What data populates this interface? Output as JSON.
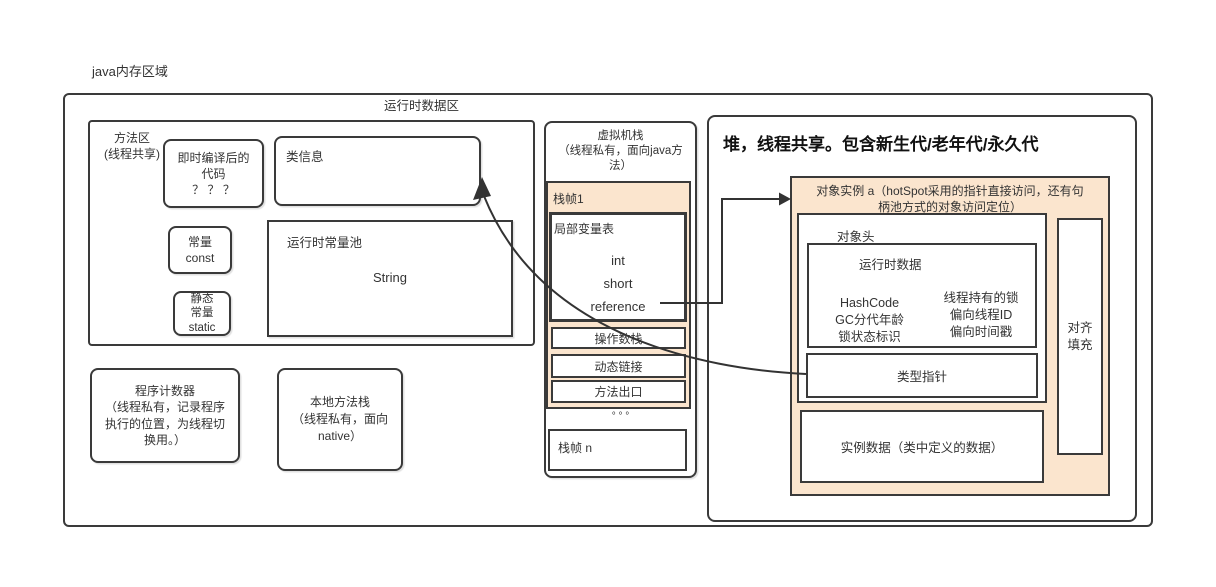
{
  "page_title": "java内存区域",
  "colors": {
    "accent_peach": "#fbe5ce",
    "line": "#3a3a3a"
  },
  "runtime_area": {
    "label": "运行时数据区"
  },
  "method_area": {
    "label_line1": "方法区",
    "label_line2": "(线程共享)",
    "jit_box": {
      "line1": "即时编译后的",
      "line2": "代码",
      "line3": "？ ？ ？"
    },
    "class_info": {
      "label": "类信息"
    },
    "const_box": {
      "line1": "常量",
      "line2": "const"
    },
    "static_box": {
      "line1": "静态",
      "line2": "常量",
      "line3": "static"
    },
    "constant_pool": {
      "label": "运行时常量池",
      "item": "String"
    }
  },
  "pc_register": {
    "line1": "程序计数器",
    "line2": "（线程私有，记录程序",
    "line3": "执行的位置，为线程切",
    "line4": "换用。）"
  },
  "native_stack": {
    "line1": "本地方法栈",
    "line2": "（线程私有，面向",
    "line3": "native）"
  },
  "vm_stack": {
    "title_line1": "虚拟机栈",
    "title_line2": "（线程私有，面向java方",
    "title_line3": "法）",
    "frame1": {
      "label": "栈帧1",
      "local_vars": {
        "label": "局部变量表",
        "items": [
          "int",
          "short",
          "reference"
        ]
      },
      "operand_stack": "操作数栈",
      "dynamic_link": "动态链接",
      "method_exit": "方法出口"
    },
    "ellipsis": "°  °  °",
    "frame_n": {
      "label": "栈帧 n"
    }
  },
  "heap": {
    "title": "堆，线程共享。包含新生代/老年代/永久代",
    "object_instance": {
      "title_line1": "对象实例 a（hotSpot采用的指针直接访问，还有句",
      "title_line2": "柄池方式的对象访问定位）",
      "object_header": {
        "label": "对象头",
        "runtime_data": {
          "label": "运行时数据",
          "left_items": [
            "HashCode",
            "GC分代年龄",
            "锁状态标识"
          ],
          "right_items": [
            "线程持有的锁",
            "偏向线程ID",
            "偏向时间戳"
          ]
        },
        "type_pointer": "类型指针"
      },
      "instance_data": "实例数据（类中定义的数据）",
      "padding": {
        "line1": "对齐",
        "line2": "填充"
      }
    }
  }
}
